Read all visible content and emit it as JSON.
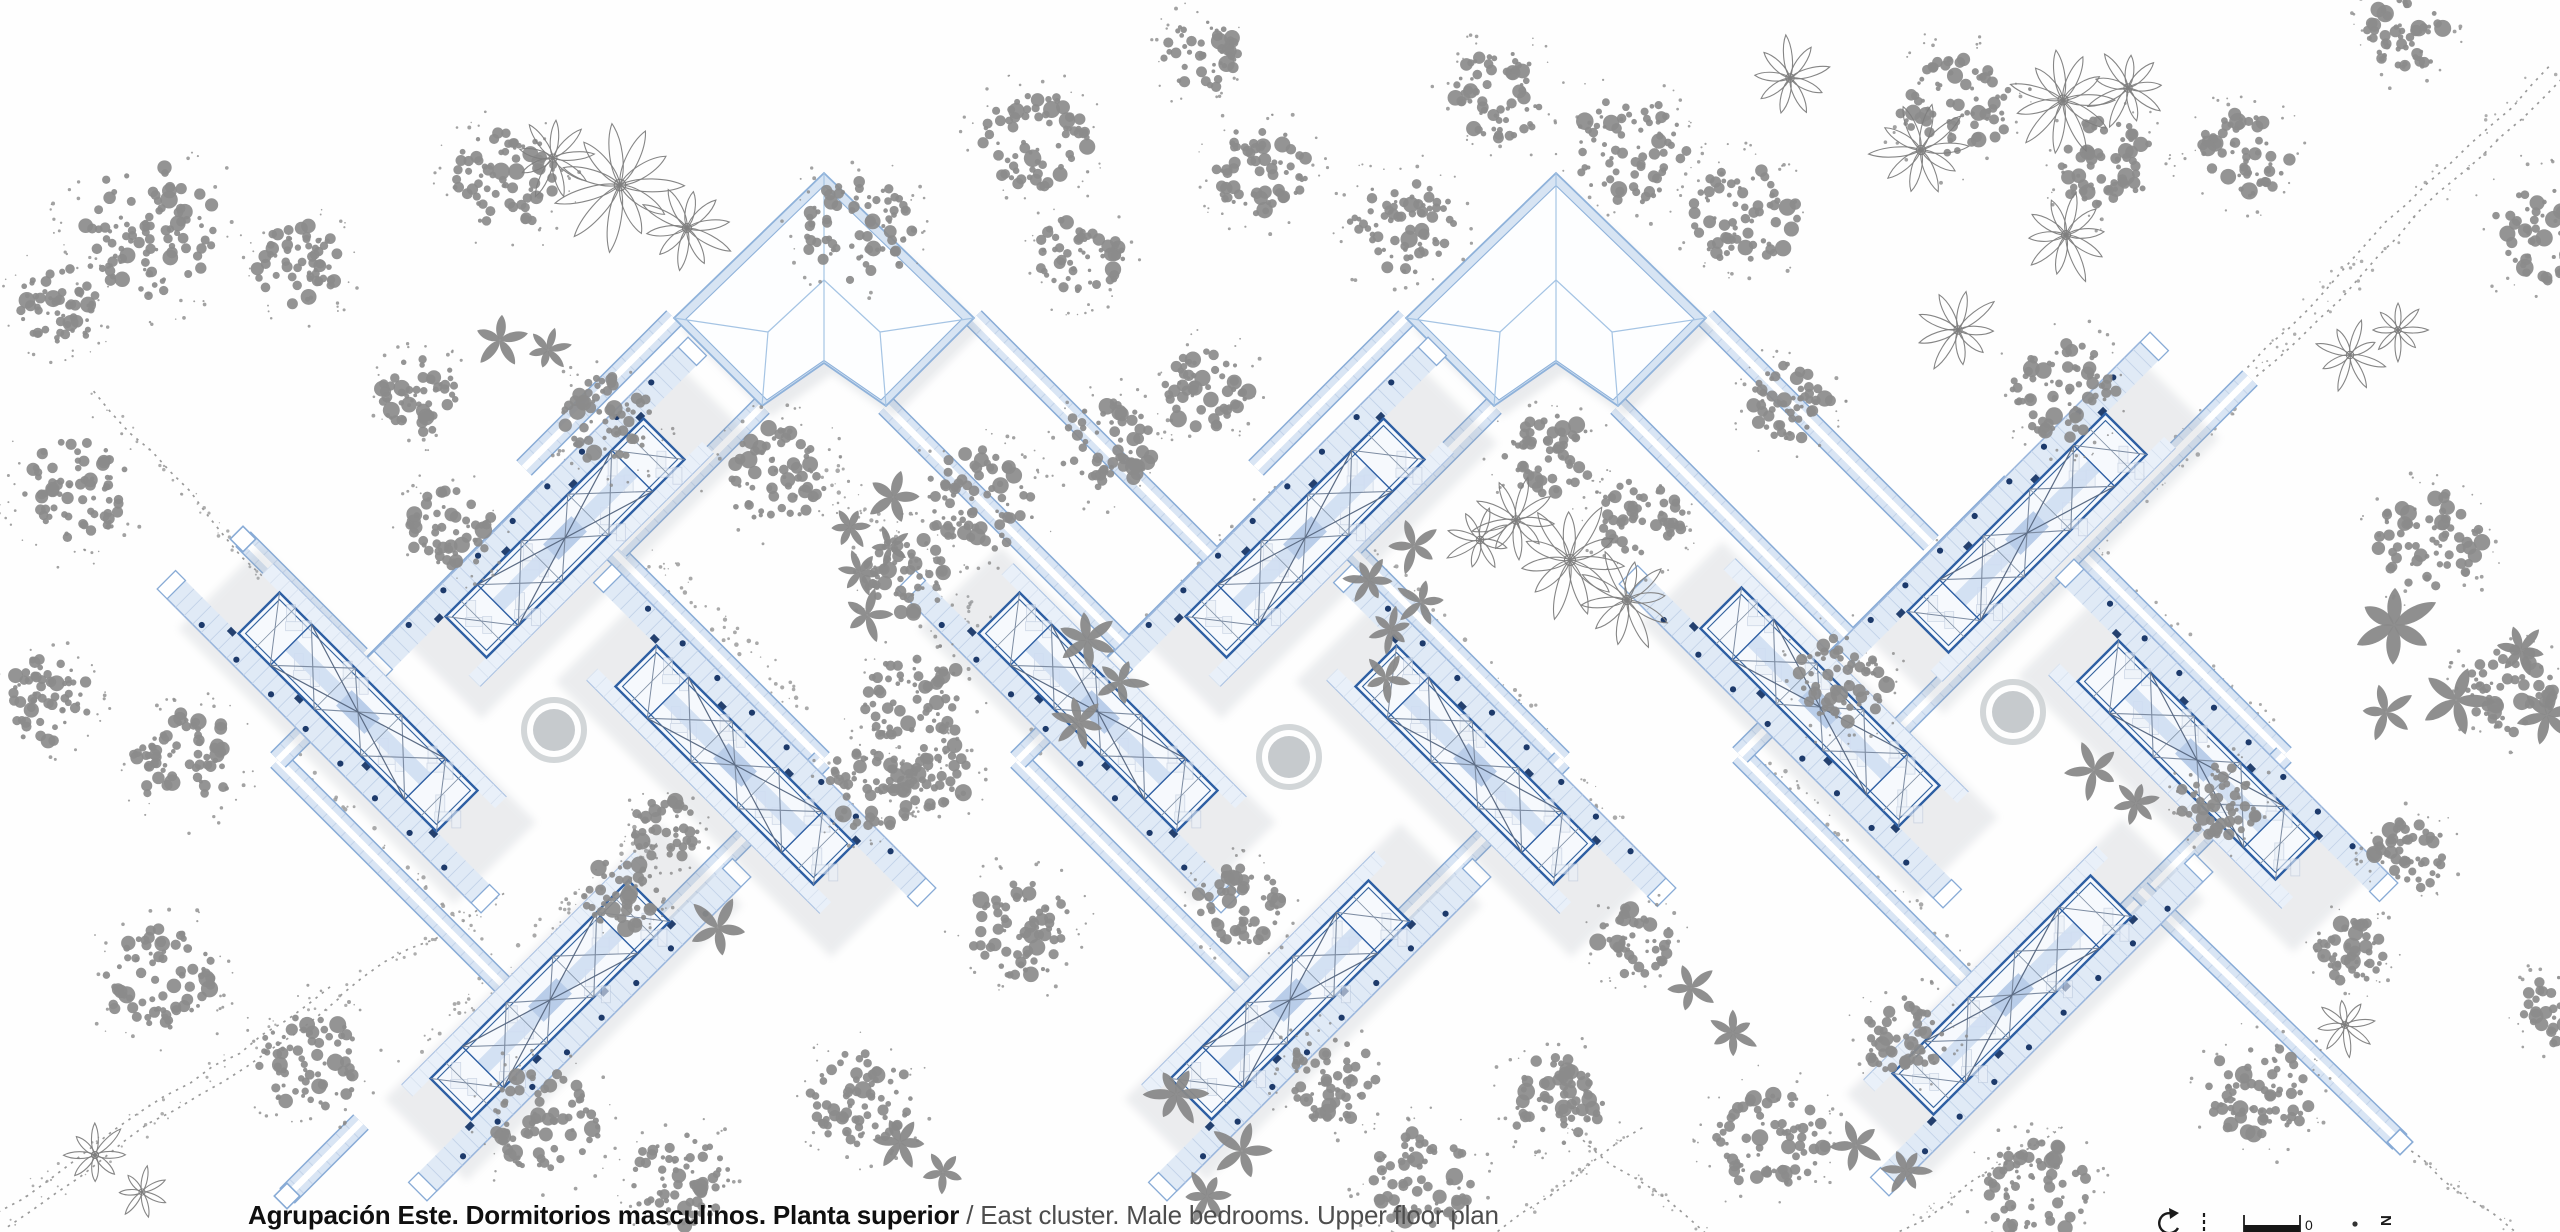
{
  "caption": {
    "spanish": "Agrupación Este. Dormitorios masculinos. Planta superior",
    "separator": " / ",
    "english": "East cluster. Male bedrooms. Upper floor plan"
  },
  "legend": {
    "zero": "0",
    "north": "N"
  },
  "colors": {
    "paper": "#fefefe",
    "corridor_edge": "#88abd6",
    "corridor_fill": "#d9e5f4",
    "corridor_spine": "#ffffff",
    "rung": "#c2d2e8",
    "walkway_fill": "#e0eaf6",
    "walkway_edge": "#9ab6dc",
    "core_fill": "#f6f9fd",
    "core_border": "#2e5fa3",
    "truss": "#7d8ca2",
    "truss_dark": "#5b6b84",
    "stripe": "#cfdef2",
    "stripe_block": "#b9cde9",
    "column_dot": "#1d3a6b",
    "door_mark": "#24406e",
    "pavilion_band": "#d7e4f3",
    "pavilion_line": "#8fb2da",
    "ridge": "#a5c4e4",
    "furniture": "#b6c3d8",
    "tree_gray": "#8b8b8b",
    "tree_outline": "#7e7e7e",
    "ground_dot": "#9b9b9b",
    "road": "#9a9a9a",
    "court_ring": "#cdd1d4",
    "court_fill": "#c3c7ca",
    "shadow": "#98a0ab",
    "ink": "#1a1a1a"
  },
  "plan": {
    "canvas": {
      "w": 2560,
      "h": 1232
    },
    "clusters": [
      {
        "cx": 550,
        "cy": 760
      },
      {
        "cx": 1290,
        "cy": 760
      },
      {
        "cx": 2012,
        "cy": 755
      }
    ],
    "ring_half": 272,
    "wing_offsets": [
      {
        "name": "north",
        "dx": 15,
        "dy": -222,
        "rot": -45,
        "walk": -1
      },
      {
        "name": "west",
        "dx": -192,
        "dy": -48,
        "rot": 45,
        "walk": 1
      },
      {
        "name": "south",
        "dx": 0,
        "dy": 240,
        "rot": -45,
        "walk": 1
      },
      {
        "name": "east",
        "dx": 185,
        "dy": 5,
        "rot": 45,
        "walk": -1
      }
    ],
    "pavilions": [
      {
        "cx": 824,
        "cy": 318
      },
      {
        "cx": 1556,
        "cy": 318
      }
    ],
    "stub_corridors": [
      [
        762,
        406,
        619,
        549
      ],
      [
        886,
        406,
        1128,
        648
      ],
      [
        674,
        318,
        524,
        468
      ],
      [
        974,
        318,
        1226,
        570
      ],
      [
        1494,
        406,
        1354,
        546
      ],
      [
        1618,
        406,
        1852,
        641
      ],
      [
        1406,
        318,
        1256,
        468
      ],
      [
        1706,
        318,
        1931,
        543
      ],
      [
        2250,
        378,
        1890,
        738
      ],
      [
        2140,
        890,
        2400,
        1142
      ],
      [
        243,
        539,
        360,
        656
      ],
      [
        361,
        1122,
        287,
        1196
      ]
    ],
    "caps": [
      [
        243,
        539,
        45
      ],
      [
        287,
        1196,
        45
      ],
      [
        2400,
        1142,
        45
      ]
    ],
    "courtyards": [
      [
        554,
        730
      ],
      [
        1289,
        757
      ],
      [
        2013,
        712
      ]
    ],
    "roads": [
      {
        "pts": [
          2252,
          372,
          2556,
          70
        ],
        "double": true
      },
      {
        "pts": [
          2,
          1218,
          338,
          992
        ],
        "double": true
      },
      {
        "pts": [
          338,
          992,
          505,
          895
        ],
        "double": false
      },
      {
        "pts": [
          2398,
          1142,
          2514,
          1232
        ],
        "double": false
      },
      {
        "pts": [
          1498,
          1232,
          1642,
          1126
        ],
        "double": false
      },
      {
        "pts": [
          1564,
          1126,
          1706,
          1232
        ],
        "double": false
      },
      {
        "pts": [
          1900,
          1232,
          2062,
          1126
        ],
        "double": false
      },
      {
        "pts": [
          95,
          390,
          262,
          576
        ],
        "double": false
      }
    ],
    "speckles": [
      [
        555,
        468,
        810,
        710
      ],
      [
        285,
        760,
        535,
        1005
      ],
      [
        825,
        470,
        1062,
        700
      ],
      [
        1030,
        750,
        1280,
        492
      ],
      [
        1300,
        488,
        1555,
        745
      ],
      [
        1795,
        710,
        2010,
        485
      ],
      [
        2020,
        485,
        2280,
        745
      ],
      [
        1750,
        755,
        2008,
        1012
      ],
      [
        405,
        1070,
        660,
        822
      ],
      [
        2090,
        545,
        2245,
        385
      ],
      [
        640,
        600,
        880,
        830
      ],
      [
        1380,
        600,
        1620,
        830
      ]
    ],
    "trees": {
      "canopy": [
        [
          150,
          230,
          75
        ],
        [
          60,
          305,
          45
        ],
        [
          300,
          265,
          46
        ],
        [
          505,
          180,
          55
        ],
        [
          860,
          230,
          58
        ],
        [
          1035,
          140,
          55
        ],
        [
          1200,
          55,
          40
        ],
        [
          1260,
          170,
          50
        ],
        [
          1080,
          255,
          45
        ],
        [
          1402,
          225,
          55
        ],
        [
          1500,
          95,
          50
        ],
        [
          1630,
          150,
          60
        ],
        [
          1745,
          215,
          55
        ],
        [
          1955,
          105,
          58
        ],
        [
          2105,
          165,
          52
        ],
        [
          2245,
          155,
          48
        ],
        [
          2405,
          35,
          42
        ],
        [
          2550,
          230,
          60
        ],
        [
          75,
          490,
          58
        ],
        [
          45,
          700,
          48
        ],
        [
          185,
          760,
          55
        ],
        [
          160,
          980,
          58
        ],
        [
          310,
          1060,
          55
        ],
        [
          420,
          395,
          42
        ],
        [
          450,
          530,
          46
        ],
        [
          610,
          420,
          50
        ],
        [
          775,
          475,
          55
        ],
        [
          980,
          500,
          58
        ],
        [
          905,
          575,
          45
        ],
        [
          1105,
          445,
          50
        ],
        [
          1207,
          390,
          45
        ],
        [
          915,
          700,
          55
        ],
        [
          935,
          775,
          40
        ],
        [
          545,
          1120,
          58
        ],
        [
          680,
          1180,
          52
        ],
        [
          860,
          1100,
          55
        ],
        [
          1020,
          930,
          55
        ],
        [
          870,
          790,
          48
        ],
        [
          665,
          830,
          35
        ],
        [
          620,
          895,
          40
        ],
        [
          1240,
          905,
          45
        ],
        [
          1330,
          1080,
          48
        ],
        [
          1420,
          1180,
          55
        ],
        [
          1555,
          1100,
          50
        ],
        [
          1770,
          1140,
          58
        ],
        [
          2035,
          1190,
          55
        ],
        [
          2260,
          1090,
          55
        ],
        [
          1905,
          1035,
          45
        ],
        [
          1635,
          940,
          40
        ],
        [
          1548,
          455,
          48
        ],
        [
          1640,
          520,
          45
        ],
        [
          1790,
          400,
          45
        ],
        [
          2065,
          390,
          55
        ],
        [
          1840,
          680,
          50
        ],
        [
          2430,
          540,
          55
        ],
        [
          2510,
          690,
          48
        ],
        [
          2220,
          800,
          42
        ],
        [
          2410,
          855,
          40
        ],
        [
          2560,
          1010,
          40
        ],
        [
          2350,
          950,
          38
        ]
      ],
      "palm_solid": [
        [
          500,
          340,
          28
        ],
        [
          548,
          350,
          22
        ],
        [
          893,
          497,
          30
        ],
        [
          850,
          527,
          22
        ],
        [
          890,
          547,
          20
        ],
        [
          860,
          572,
          22
        ],
        [
          867,
          615,
          26
        ],
        [
          1087,
          640,
          30
        ],
        [
          1120,
          682,
          26
        ],
        [
          1079,
          722,
          26
        ],
        [
          718,
          928,
          30
        ],
        [
          900,
          1142,
          28
        ],
        [
          943,
          1172,
          24
        ],
        [
          1176,
          1094,
          30
        ],
        [
          1242,
          1151,
          30
        ],
        [
          1207,
          1196,
          26
        ],
        [
          1414,
          546,
          26
        ],
        [
          1369,
          580,
          24
        ],
        [
          1421,
          602,
          24
        ],
        [
          1391,
          630,
          22
        ],
        [
          1386,
          678,
          24
        ],
        [
          2394,
          625,
          42
        ],
        [
          2456,
          700,
          36
        ],
        [
          2547,
          715,
          30
        ],
        [
          2386,
          712,
          28
        ],
        [
          2521,
          650,
          26
        ],
        [
          2094,
          770,
          28
        ],
        [
          2136,
          803,
          24
        ],
        [
          1856,
          1145,
          28
        ],
        [
          1906,
          1170,
          24
        ],
        [
          1691,
          988,
          26
        ],
        [
          1733,
          1033,
          24
        ]
      ],
      "palm_outline": [
        [
          620,
          185,
          60,
          11
        ],
        [
          553,
          158,
          38,
          9
        ],
        [
          687,
          228,
          44,
          10
        ],
        [
          1790,
          78,
          40,
          9
        ],
        [
          1921,
          150,
          46,
          10
        ],
        [
          2063,
          100,
          50,
          11
        ],
        [
          2128,
          88,
          40,
          9
        ],
        [
          2066,
          235,
          44,
          10
        ],
        [
          1958,
          330,
          40,
          9
        ],
        [
          1570,
          560,
          56,
          11
        ],
        [
          1516,
          520,
          40,
          9
        ],
        [
          1627,
          600,
          46,
          10
        ],
        [
          1480,
          540,
          34,
          8
        ],
        [
          2350,
          355,
          34,
          8
        ],
        [
          2398,
          330,
          28,
          8
        ],
        [
          95,
          1155,
          32,
          8
        ],
        [
          142,
          1192,
          26,
          7
        ],
        [
          2345,
          1025,
          30,
          8
        ]
      ]
    },
    "scalebar": {
      "north_arrow": [
        2168,
        1224
      ],
      "tick": [
        2204,
        1213
      ],
      "bar": [
        2244,
        1221,
        56,
        11
      ],
      "zero_pos": [
        2305,
        1230
      ],
      "dot": [
        2355,
        1224
      ],
      "north_pos": [
        2391,
        1226
      ]
    }
  }
}
